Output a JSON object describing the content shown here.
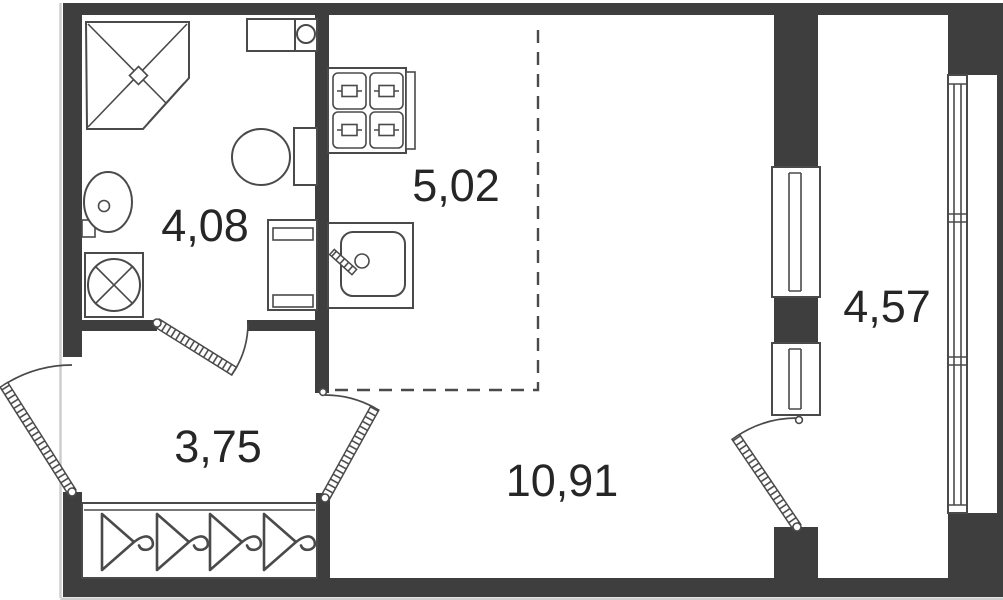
{
  "document": {
    "type": "apartment-floor-plan",
    "title": "Studio apartment floor plan"
  },
  "rooms": [
    {
      "name": "bathroom",
      "area": "4,08"
    },
    {
      "name": "kitchen",
      "area": "5,02"
    },
    {
      "name": "hallway",
      "area": "3,75"
    },
    {
      "name": "living-room",
      "area": "10,91"
    },
    {
      "name": "balcony",
      "area": "4,57"
    }
  ],
  "fixtures": [
    "corner-shower",
    "washbasin",
    "washing-machine",
    "toilet",
    "bathroom-cabinet",
    "boiler-unit",
    "stove-4-burner",
    "kitchen-sink",
    "wardrobe-with-hangers",
    "entrance-door",
    "bathroom-door",
    "room-door",
    "balcony-door",
    "balcony-window",
    "balcony-glazing",
    "kitchen-zone-dashed-boundary"
  ],
  "colors": {
    "wall": "#3e3e3e",
    "line": "#4a4a4a",
    "text": "#262626",
    "background": "#ffffff"
  }
}
